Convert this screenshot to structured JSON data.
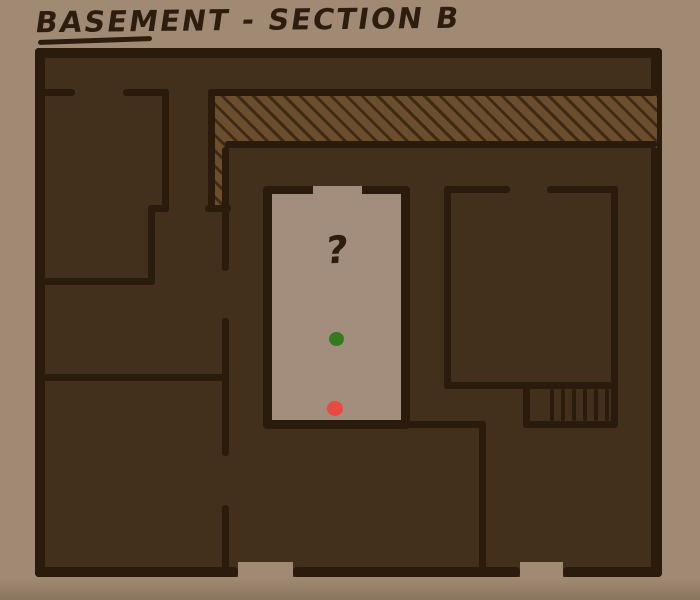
{
  "title": "BASEMENT - SECTION B",
  "colors": {
    "background": "#a08a74",
    "floor": "#42301c",
    "wall": "#2a1b0d",
    "ink": "#2c1d0e",
    "hatch_fill": "#6b4e2e",
    "hatch_line": "#3e2b16",
    "room_fill": "#a38d7c",
    "green_marker": "#357a1e",
    "red_marker": "#e84942"
  },
  "markers": {
    "unknown": {
      "label": "?"
    },
    "green": {
      "meaning": "green dot marker"
    },
    "red": {
      "meaning": "red dot marker"
    }
  }
}
